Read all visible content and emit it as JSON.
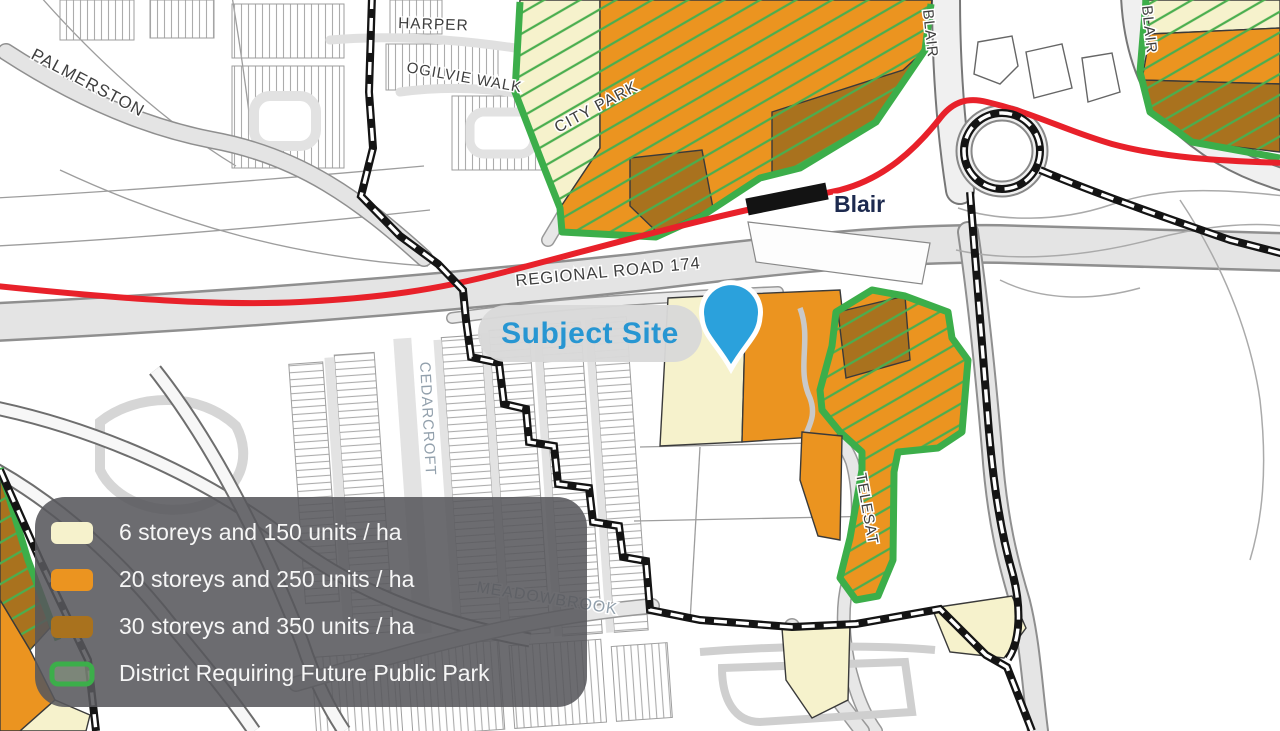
{
  "map": {
    "street_labels": [
      {
        "text": "PALMERSTON"
      },
      {
        "text": "HARPER"
      },
      {
        "text": "OGILVIE WALK"
      },
      {
        "text": "CITY PARK"
      },
      {
        "text": "BLAIR"
      },
      {
        "text": "BLAIR"
      },
      {
        "text": "REGIONAL ROAD 174"
      },
      {
        "text": "CEDARCROFT"
      },
      {
        "text": "MEADOWBROOK"
      },
      {
        "text": "TELESAT"
      }
    ],
    "station": {
      "name": "Blair"
    },
    "subject_site": {
      "label": "Subject Site"
    }
  },
  "legend": {
    "items": [
      {
        "label": "6 storeys and 150 units / ha",
        "color": "#F6F2CC",
        "style": "fill"
      },
      {
        "label": "20 storeys and 250 units / ha",
        "color": "#EB9420",
        "style": "fill"
      },
      {
        "label": "30 storeys and 350 units / ha",
        "color": "#A9721E",
        "style": "fill"
      },
      {
        "label": "District Requiring Future Public Park",
        "color": "#3CAE4A",
        "style": "outline"
      }
    ]
  },
  "colors": {
    "zone_6_storeys": "#F6F2CC",
    "zone_20_storeys": "#EB9420",
    "zone_30_storeys": "#A9721E",
    "park_district_border": "#3CAE4A",
    "park_district_hatch": "#4BAE4F",
    "transit_line": "#E8212A",
    "station_marker": "#131313",
    "boundary": "#141414",
    "pin": "#2BA1DC",
    "subject_site_text": "#2796D2",
    "legend_background": "#58585C"
  }
}
